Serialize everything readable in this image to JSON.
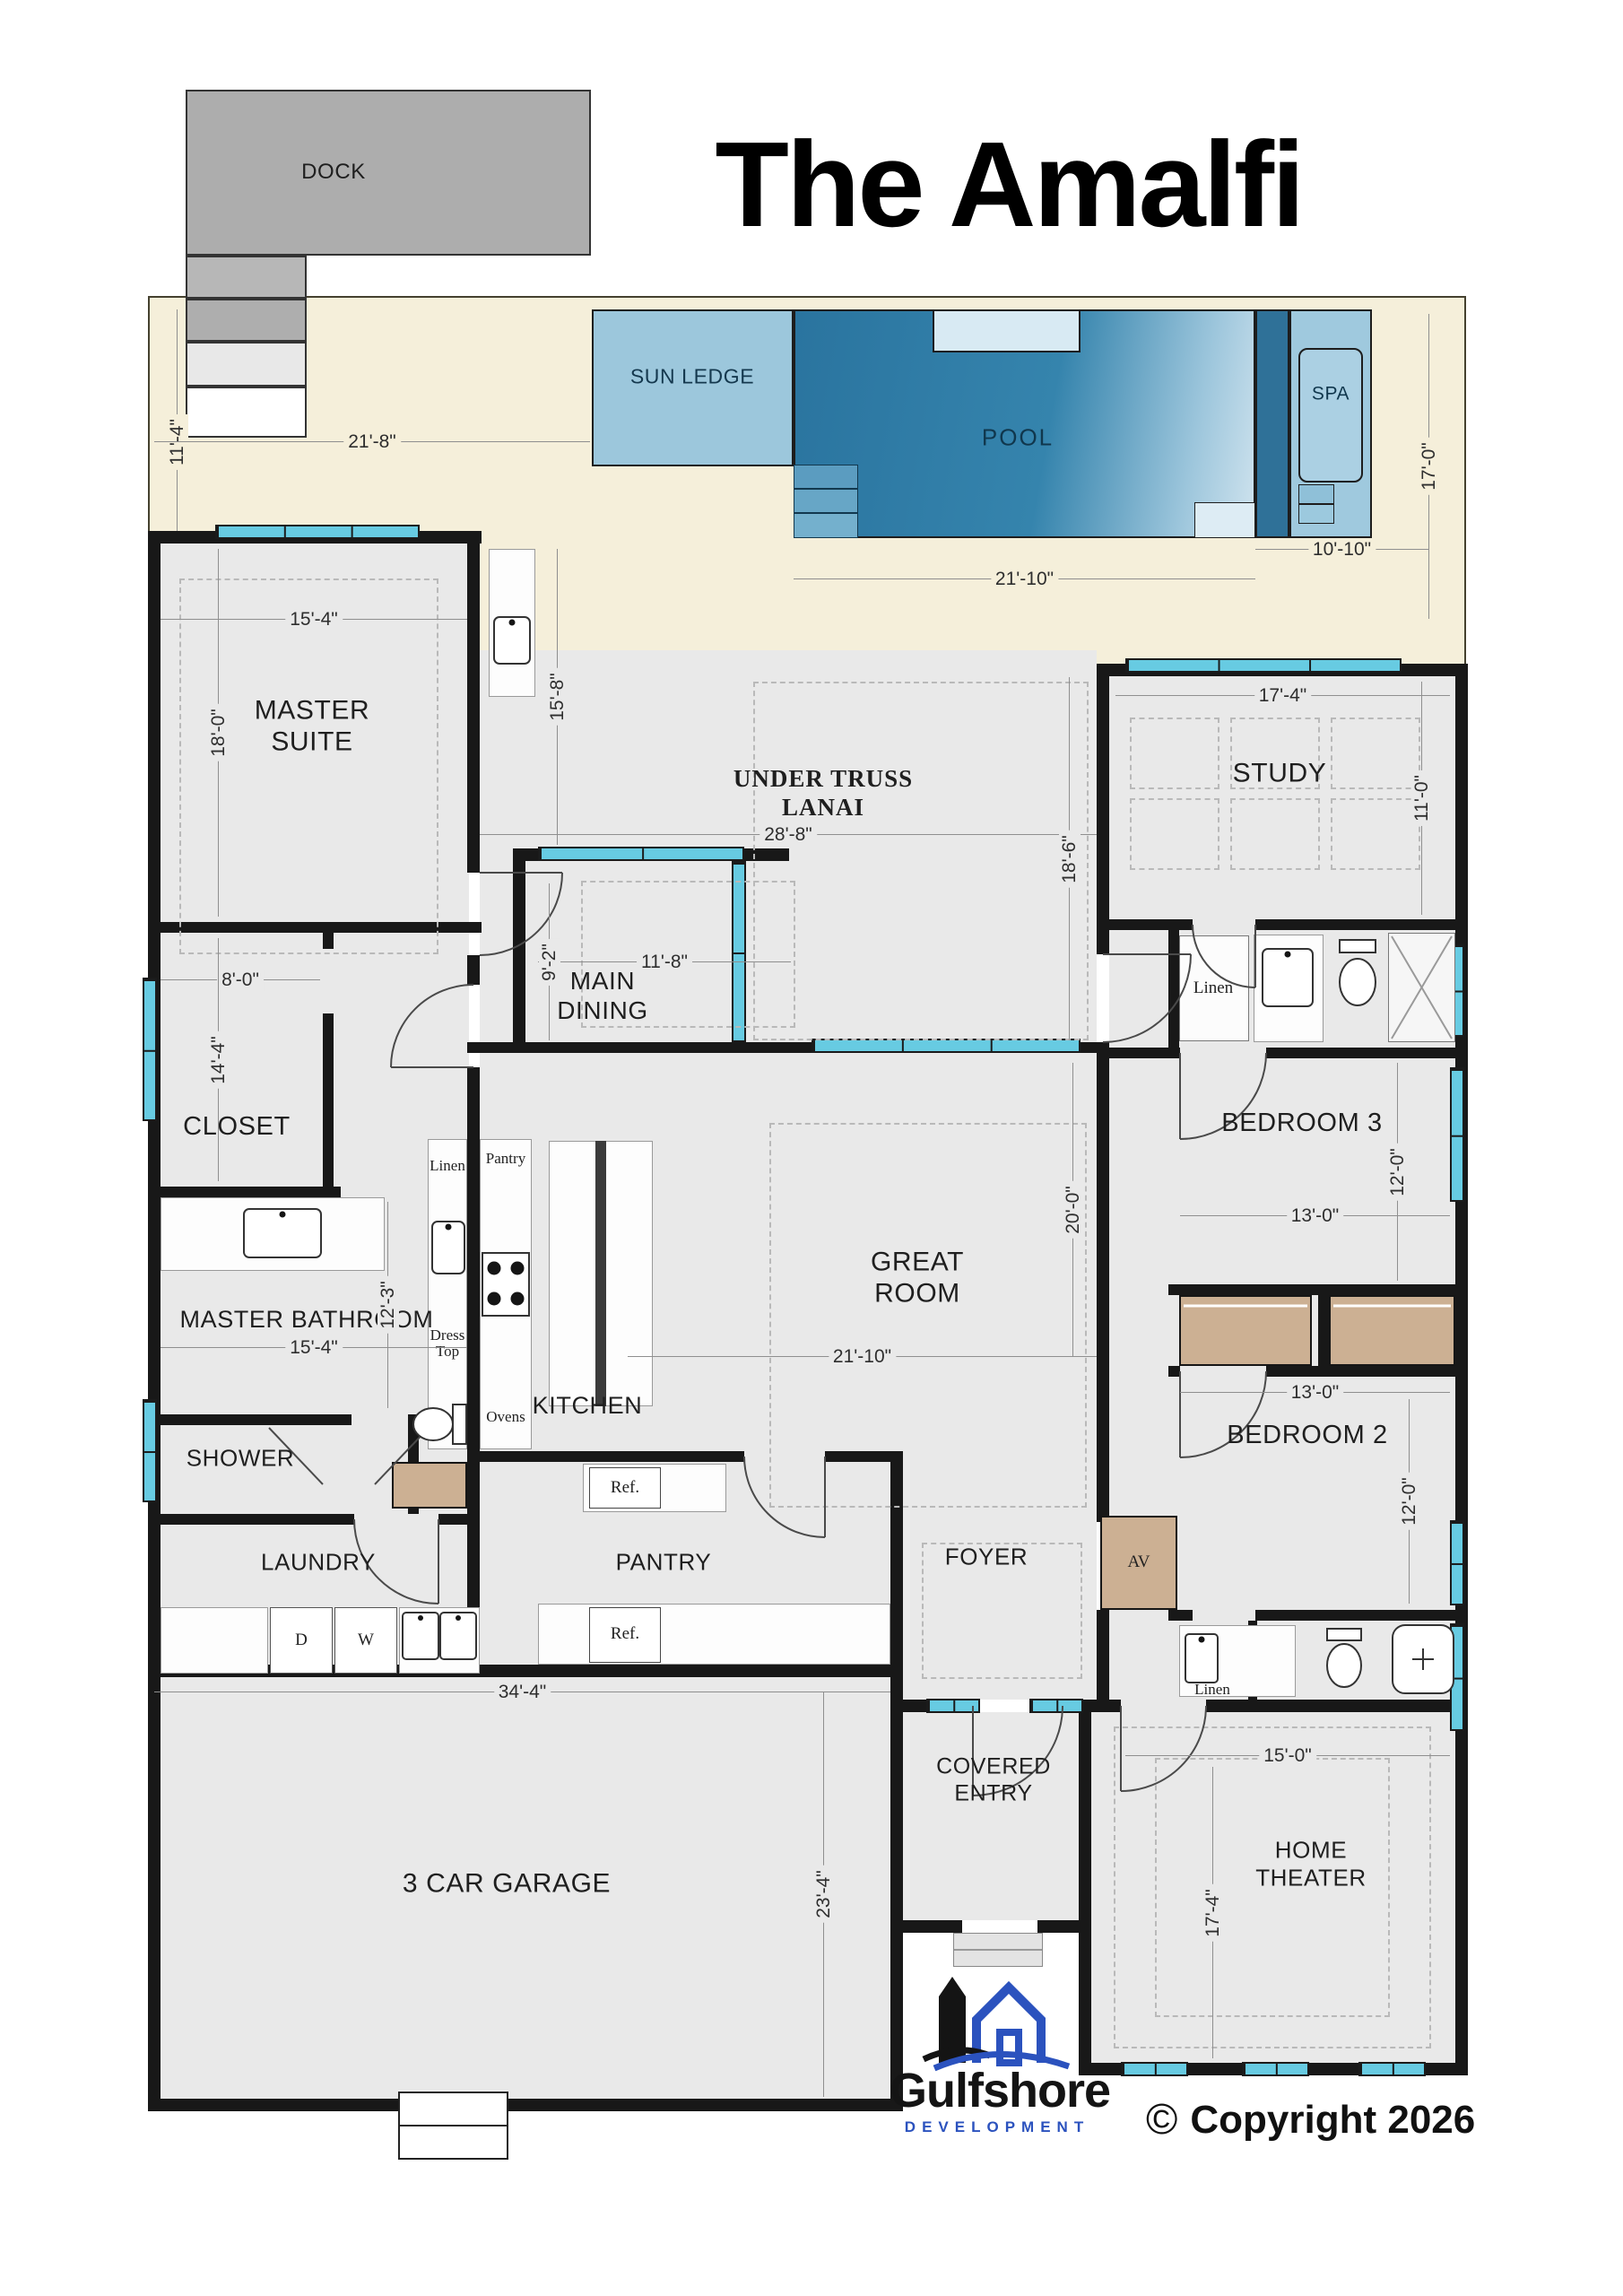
{
  "title": "The Amalfi",
  "site": {
    "dock": "DOCK",
    "sun_ledge": "SUN LEDGE",
    "pool": "POOL",
    "spa": "SPA"
  },
  "rooms": {
    "master_suite_line1": "MASTER",
    "master_suite_line2": "SUITE",
    "lanai_line1": "UNDER TRUSS",
    "lanai_line2": "LANAI",
    "study": "STUDY",
    "main_dining_line1": "MAIN",
    "main_dining_line2": "DINING",
    "closet": "CLOSET",
    "bedroom3": "BEDROOM 3",
    "great_room_line1": "GREAT",
    "great_room_line2": "ROOM",
    "master_bathroom": "MASTER BATHROOM",
    "kitchen": "KITCHEN",
    "shower": "SHOWER",
    "laundry": "LAUNDRY",
    "pantry": "PANTRY",
    "foyer": "FOYER",
    "bedroom2": "BEDROOM 2",
    "garage": "3 CAR GARAGE",
    "covered_entry_line1": "COVERED",
    "covered_entry_line2": "ENTRY",
    "home_theater_line1": "HOME",
    "home_theater_line2": "THEATER"
  },
  "fixtures": {
    "linen_bath3": "Linen",
    "linen_kitchen": "Linen",
    "pantry_cabinet": "Pantry",
    "dress_top_line1": "Dress",
    "dress_top_line2": "Top",
    "ovens": "Ovens",
    "fridge_top": "Ref.",
    "fridge_bottom": "Ref.",
    "dryer": "D",
    "washer": "W",
    "av_closet": "AV",
    "linen_bath2": "Linen"
  },
  "dims": {
    "deck_height": "11'-4\"",
    "deck_width": "21'-8\"",
    "pool_height": "17'-0\"",
    "spa_width": "10'-10\"",
    "pool_width": "21'-10\"",
    "master_width": "15'-4\"",
    "master_height": "18'-0\"",
    "lanai_left_height": "15'-8\"",
    "lanai_width": "28'-8\"",
    "lanai_height": "18'-6\"",
    "study_width": "17'-4\"",
    "study_height": "11'-0\"",
    "dining_width": "11'-8\"",
    "dining_height": "9'-2\"",
    "closet_width": "8'-0\"",
    "closet_height": "14'-4\"",
    "bedroom3_width": "13'-0\"",
    "bedroom3_height": "12'-0\"",
    "great_width": "21'-10\"",
    "great_height": "20'-0\"",
    "mbath_width": "15'-4\"",
    "mbath_height": "12'-3\"",
    "bedroom2_width": "13'-0\"",
    "bedroom2_height": "12'-0\"",
    "garage_width": "34'-4\"",
    "garage_height": "23'-4\"",
    "theater_width": "15'-0\"",
    "theater_height": "17'-4\""
  },
  "footer": {
    "brand": "Gulfshore",
    "brand_sub": "DEVELOPMENT",
    "copyright_symbol": "©",
    "copyright": "Copyright 2026"
  },
  "colors": {
    "deck": "#f5efda",
    "pool": "#2a749f",
    "sun_ledge": "#9cc7dc",
    "spa": "#9fc9de",
    "wall": "#181818",
    "floor": "#e9e9e9",
    "window": "#67cbe2",
    "closet_tan": "#ccb093",
    "dock": "#adadad",
    "logo_blue": "#2b52be"
  }
}
